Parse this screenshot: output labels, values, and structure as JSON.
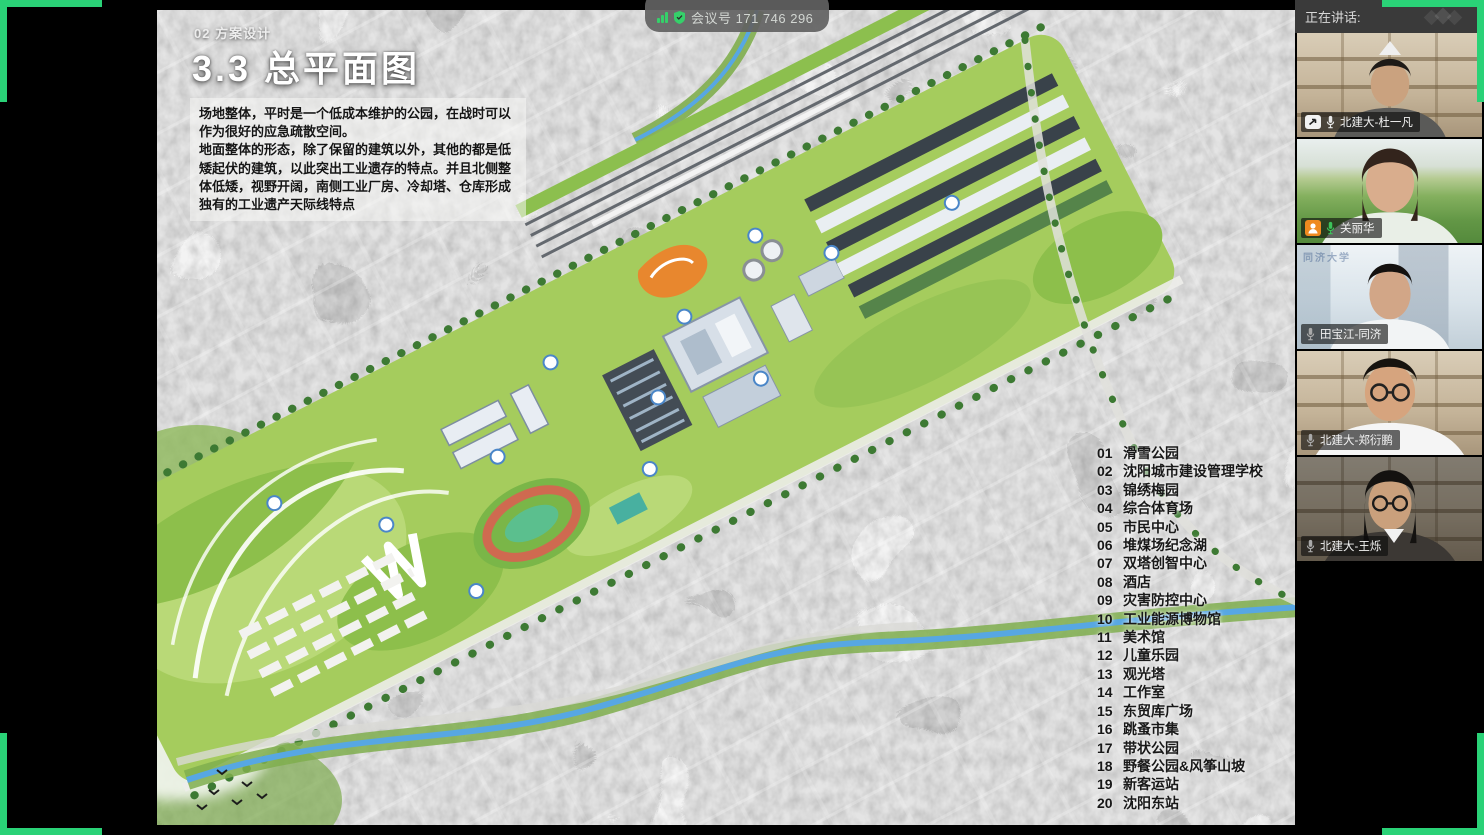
{
  "meeting": {
    "id_label": "会议号 171 746 296"
  },
  "slide": {
    "section_label": "02 方案设计",
    "title": "3.3 总平面图",
    "paragraph1": "场地整体，平时是一个低成本维护的公园，在战时可以作为很好的应急疏散空间。",
    "paragraph2": "地面整体的形态，除了保留的建筑以外，其他的都是低矮起伏的建筑，以此突出工业遗存的特点。并且北侧整体低矮，视野开阔，南侧工业厂房、冷却塔、仓库形成独有的工业遗产天际线特点",
    "legend": [
      {
        "num": "01",
        "label": "滑雪公园"
      },
      {
        "num": "02",
        "label": "沈阳城市建设管理学校"
      },
      {
        "num": "03",
        "label": "锦绣梅园"
      },
      {
        "num": "04",
        "label": "综合体育场"
      },
      {
        "num": "05",
        "label": "市民中心"
      },
      {
        "num": "06",
        "label": "堆煤场纪念湖"
      },
      {
        "num": "07",
        "label": "双塔创智中心"
      },
      {
        "num": "08",
        "label": "酒店"
      },
      {
        "num": "09",
        "label": "灾害防控中心"
      },
      {
        "num": "10",
        "label": "工业能源博物馆"
      },
      {
        "num": "11",
        "label": "美术馆"
      },
      {
        "num": "12",
        "label": "儿童乐园"
      },
      {
        "num": "13",
        "label": "观光塔"
      },
      {
        "num": "14",
        "label": "工作室"
      },
      {
        "num": "15",
        "label": "东贸库广场"
      },
      {
        "num": "16",
        "label": "跳蚤市集"
      },
      {
        "num": "17",
        "label": "带状公园"
      },
      {
        "num": "18",
        "label": "野餐公园&风筝山坡"
      },
      {
        "num": "19",
        "label": "新客运站"
      },
      {
        "num": "20",
        "label": "沈阳东站"
      }
    ]
  },
  "sidebar": {
    "header": "正在讲话:",
    "participants": [
      {
        "name": "北建大-杜一凡",
        "mic": "on",
        "sharing": true
      },
      {
        "name": "关丽华",
        "mic": "on",
        "has_avatar_badge": true
      },
      {
        "name": "田宝江-同济",
        "mic": "muted",
        "watermark": "同济大学"
      },
      {
        "name": "北建大-郑衍鹏",
        "mic": "muted"
      },
      {
        "name": "北建大-王烁",
        "mic": "muted"
      }
    ]
  },
  "colors": {
    "bracket_green": "#2ad277",
    "mic_on_green": "#3cc25a",
    "avatar_orange": "#ef8a1f",
    "river_blue": "#57a7e3",
    "park_green": "#a5cc5d"
  }
}
